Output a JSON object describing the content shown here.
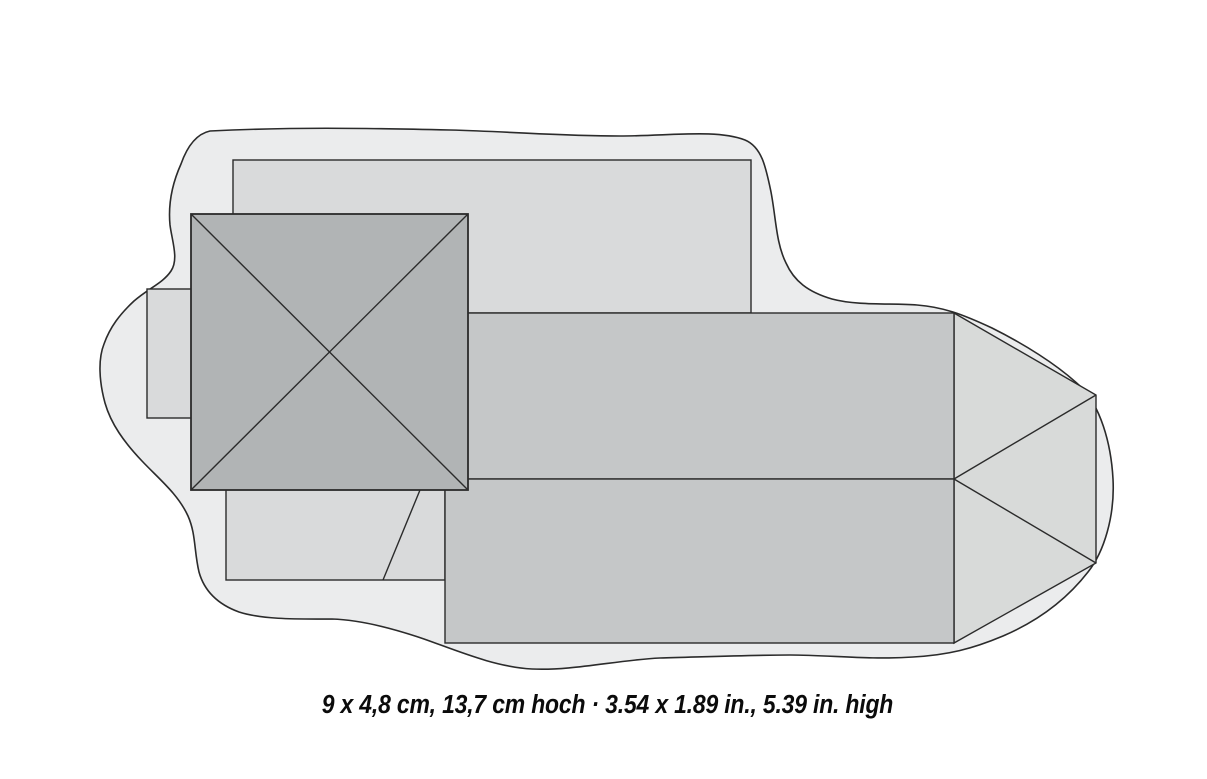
{
  "caption": {
    "text": "9 x 4,8 cm, 13,7 cm hoch · 3.54 x 1.89 in., 5.39 in. high"
  },
  "colors": {
    "page": "#ffffff",
    "baseplate": "#ebeced",
    "light-roof": "#d9dadb",
    "nave-roof": "#c5c7c8",
    "apse-roof": "#d8dad9",
    "tower-roof": "#b1b4b5",
    "outline": "#2b2b2b",
    "caption": "#0b0b0b"
  },
  "figure": {
    "parts": [
      "baseplate-outline",
      "rear-annex-roof",
      "porch",
      "side-annex-roof",
      "nave-roof-upper-slope",
      "nave-roof-lower-slope",
      "apse-hip-roof",
      "tower-pyramid-roof"
    ]
  }
}
